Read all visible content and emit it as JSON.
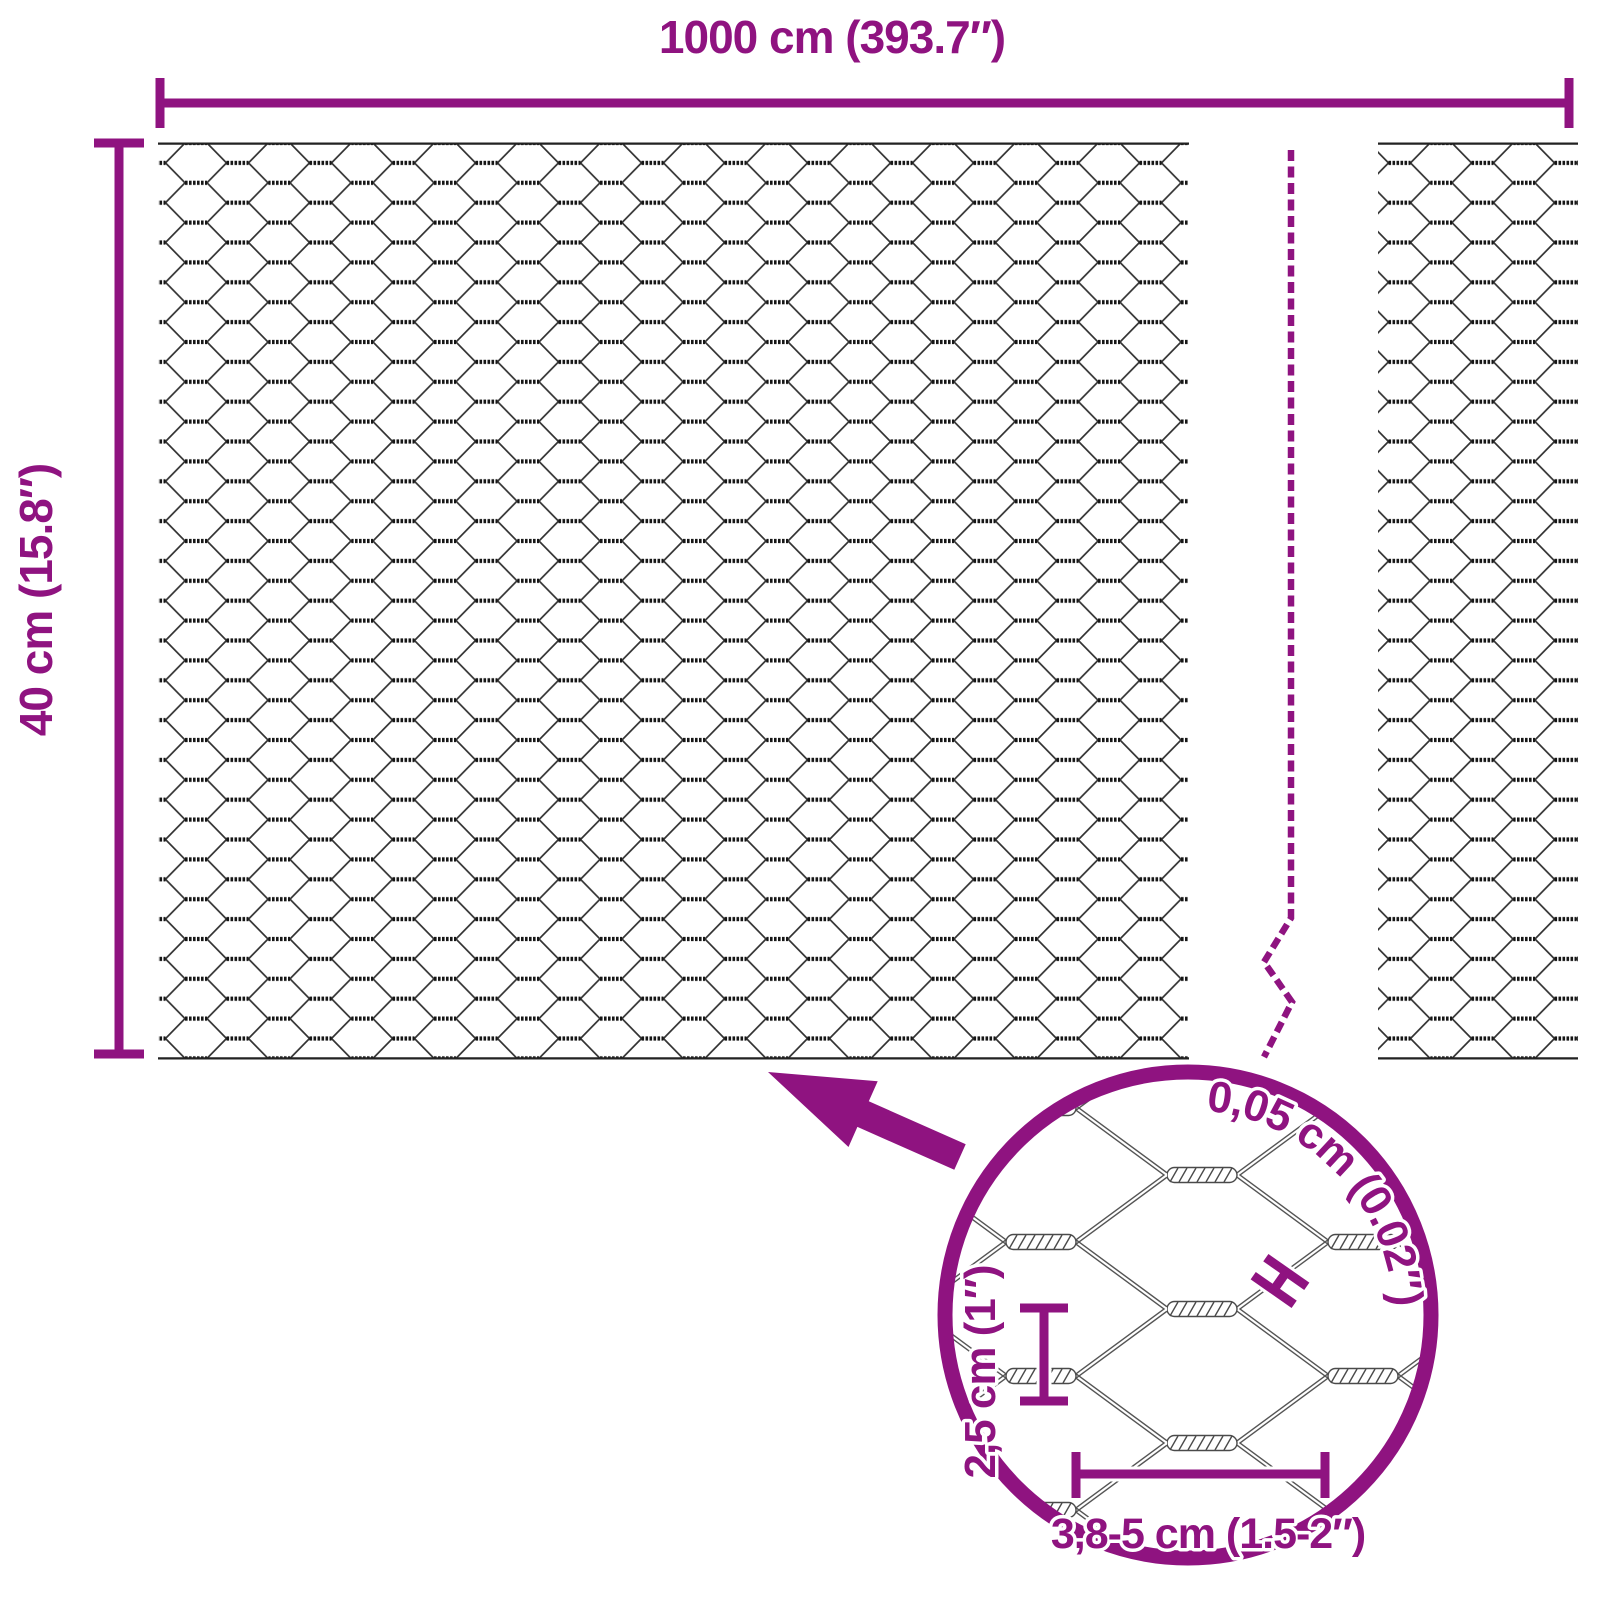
{
  "diagram": {
    "type": "product-dimension-diagram",
    "subject": "hexagonal-wire-mesh-roll",
    "accent_color": "#8F1380",
    "wire_color": "#333333",
    "labels": {
      "total_length": "1000 cm (393.7″)",
      "roll_height": "40 cm (15.8″)",
      "wire_thickness": "0,05 cm (0.02″)",
      "mesh_height": "2,5 cm (1″)",
      "mesh_width": "3,8-5 cm (1.5-2″)"
    }
  }
}
